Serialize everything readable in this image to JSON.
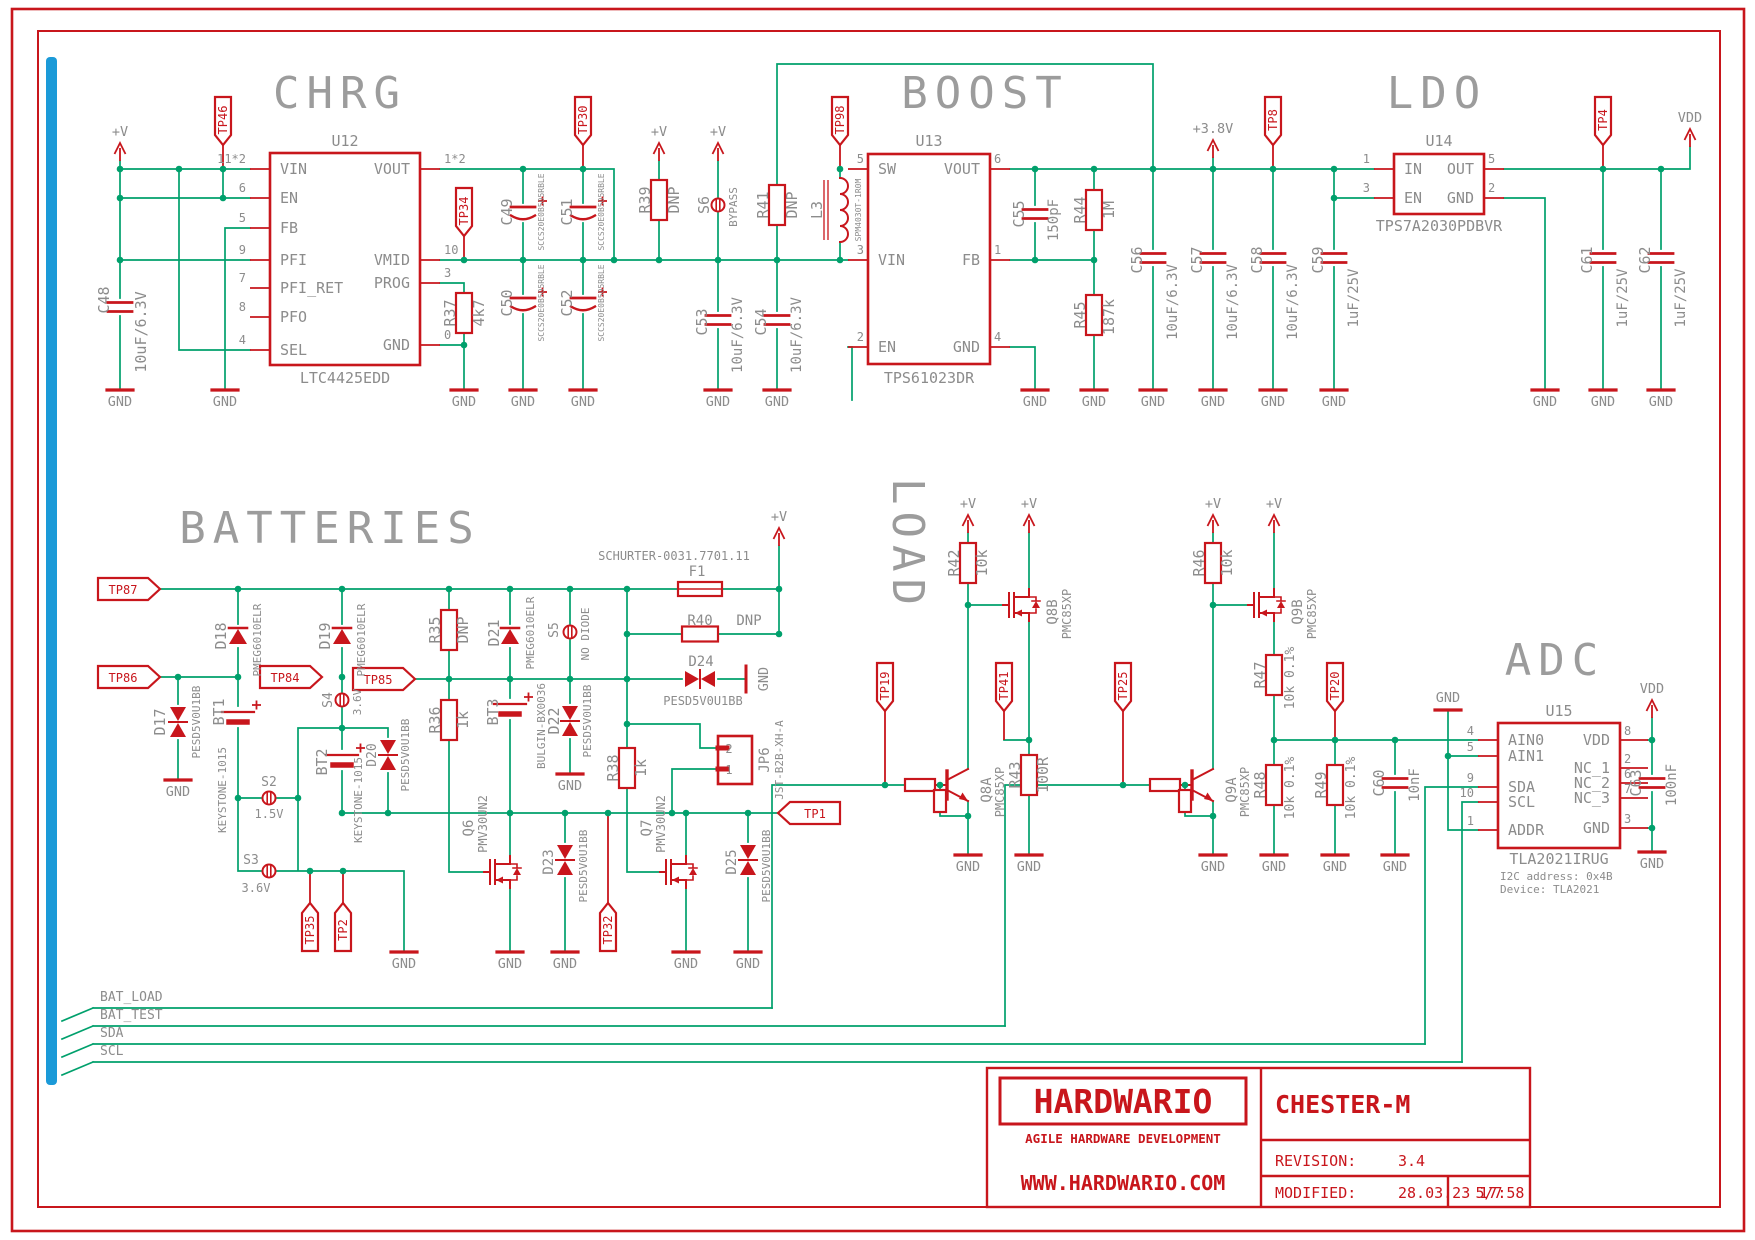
{
  "titles": {
    "chrg": "CHRG",
    "boost": "BOOST",
    "ldo": "LDO",
    "bat": "BATTERIES",
    "load": "LOAD",
    "adc": "ADC"
  },
  "sym": {
    "gnd": "GND",
    "pv": "+V",
    "v38": "+3.8V",
    "vdd": "VDD"
  },
  "tp": {
    "tp1": "TP1",
    "tp2": "TP2",
    "tp4": "TP4",
    "tp8": "TP8",
    "tp19": "TP19",
    "tp20": "TP20",
    "tp25": "TP25",
    "tp30": "TP30",
    "tp32": "TP32",
    "tp34": "TP34",
    "tp35": "TP35",
    "tp41": "TP41",
    "tp46": "TP46",
    "tp84": "TP84",
    "tp85": "TP85",
    "tp86": "TP86",
    "tp87": "TP87",
    "tp98": "TP98"
  },
  "nets": {
    "bat_load": "BAT_LOAD",
    "bat_test": "BAT_TEST",
    "sda": "SDA",
    "scl": "SCL"
  },
  "ics": {
    "u12": {
      "ref": "U12",
      "part": "LTC4425EDD",
      "lp": [
        {
          "num": "11*2",
          "n": "VIN"
        },
        {
          "num": "6",
          "n": "EN"
        },
        {
          "num": "5",
          "n": "FB"
        },
        {
          "num": "9",
          "n": "PFI"
        },
        {
          "num": "7",
          "n": "PFI_RET"
        },
        {
          "num": "8",
          "n": "PFO"
        },
        {
          "num": "4",
          "n": "SEL"
        }
      ],
      "rp": [
        {
          "num": "1*2",
          "n": "VOUT"
        },
        {
          "num": "10",
          "n": "VMID"
        },
        {
          "num": "3",
          "n": "PROG"
        },
        {
          "num": "0",
          "n": "GND"
        }
      ]
    },
    "u13": {
      "ref": "U13",
      "part": "TPS61023DR",
      "lp": [
        {
          "num": "5",
          "n": "SW"
        },
        {
          "num": "3",
          "n": "VIN"
        },
        {
          "num": "2",
          "n": "EN"
        }
      ],
      "rp": [
        {
          "num": "6",
          "n": "VOUT"
        },
        {
          "num": "1",
          "n": "FB"
        },
        {
          "num": "4",
          "n": "GND"
        }
      ]
    },
    "u14": {
      "ref": "U14",
      "part": "TPS7A2030PDBVR",
      "lp": [
        {
          "num": "1",
          "n": "IN"
        },
        {
          "num": "3",
          "n": "EN"
        }
      ],
      "rp": [
        {
          "num": "5",
          "n": "OUT"
        },
        {
          "num": "2",
          "n": "GND"
        }
      ]
    },
    "u15": {
      "ref": "U15",
      "part": "TLA2021IRUG",
      "note1": "I2C address: 0x4B",
      "note2": "Device: TLA2021",
      "lp": [
        {
          "num": "4",
          "n": "AIN0"
        },
        {
          "num": "5",
          "n": "AIN1"
        },
        {
          "num": "9",
          "n": "SDA"
        },
        {
          "num": "10",
          "n": "SCL"
        },
        {
          "num": "1",
          "n": "ADDR"
        }
      ],
      "rp": [
        {
          "num": "8",
          "n": "VDD"
        },
        {
          "num": "2",
          "n": "NC_1"
        },
        {
          "num": "6",
          "n": "NC_2"
        },
        {
          "num": "7",
          "n": "NC_3"
        },
        {
          "num": "3",
          "n": "GND"
        }
      ]
    }
  },
  "parts": {
    "c48": {
      "r": "C48",
      "v": "10uF/6.3V"
    },
    "c49": {
      "r": "C49",
      "v": "SCCS20E0B505RBLE"
    },
    "c50": {
      "r": "C50",
      "v": "SCCS20E0B505RBLE"
    },
    "c51": {
      "r": "C51",
      "v": "SCCS20E0B505RBLE"
    },
    "c52": {
      "r": "C52",
      "v": "SCCS20E0B505RBLE"
    },
    "r37": {
      "r": "R37",
      "v": "4k7"
    },
    "r39": {
      "r": "R39",
      "v": "DNP"
    },
    "s6": {
      "r": "S6",
      "v": "BYPASS"
    },
    "r41": {
      "r": "R41",
      "v": "DNP"
    },
    "l3": {
      "r": "L3",
      "v": "SPM4030T-1R0M"
    },
    "c53": {
      "r": "C53",
      "v": "10uF/6.3V"
    },
    "c54": {
      "r": "C54",
      "v": "10uF/6.3V"
    },
    "c55": {
      "r": "C55",
      "v": "150pF"
    },
    "r44": {
      "r": "R44",
      "v": "1M"
    },
    "r45": {
      "r": "R45",
      "v": "187k"
    },
    "c56": {
      "r": "C56",
      "v": "10uF/6.3V"
    },
    "c57": {
      "r": "C57",
      "v": "10uF/6.3V"
    },
    "c58": {
      "r": "C58",
      "v": "10uF/6.3V"
    },
    "c59": {
      "r": "C59",
      "v": "1uF/25V"
    },
    "c61": {
      "r": "C61",
      "v": "1uF/25V"
    },
    "c62": {
      "r": "C62",
      "v": "1uF/25V"
    },
    "d17": {
      "r": "D17",
      "v": "PESD5V0U1BB"
    },
    "d18": {
      "r": "D18",
      "v": "PMEG6010ELR"
    },
    "d19": {
      "r": "D19",
      "v": "PMEG6010ELR"
    },
    "bt1": {
      "r": "BT1",
      "v": "KEYSTONE-1015"
    },
    "bt2": {
      "r": "BT2",
      "v": "KEYSTONE-1015"
    },
    "bt3": {
      "r": "BT3",
      "v": "BULGIN-BX0036"
    },
    "s2": {
      "r": "S2",
      "v": "1.5V"
    },
    "s3": {
      "r": "S3",
      "v": "3.6V"
    },
    "s4": {
      "r": "S4",
      "v": "3.6V"
    },
    "s5": {
      "r": "S5",
      "v": "NO DIODE"
    },
    "d20": {
      "r": "D20",
      "v": "PESD5V0U1BB"
    },
    "r35": {
      "r": "R35",
      "v": "DNP"
    },
    "r36": {
      "r": "R36",
      "v": "1k"
    },
    "d21": {
      "r": "D21",
      "v": "PMEG6010ELR"
    },
    "d22": {
      "r": "D22",
      "v": "PESD5V0U1BB"
    },
    "q6": {
      "r": "Q6",
      "v": "PMV30UN2"
    },
    "q7": {
      "r": "Q7",
      "v": "PMV30UN2"
    },
    "d23": {
      "r": "D23",
      "v": "PESD5V0U1BB"
    },
    "d24": {
      "r": "D24",
      "v": "PESD5V0U1BB"
    },
    "d25": {
      "r": "D25",
      "v": "PESD5V0U1BB"
    },
    "f1": {
      "r": "F1",
      "v": "SCHURTER-0031.7701.11"
    },
    "r40": {
      "r": "R40",
      "v": "DNP"
    },
    "r38": {
      "r": "R38",
      "v": "1k"
    },
    "jp6": {
      "r": "JP6",
      "v": "JST-B2B-XH-A",
      "p1": "1",
      "p2": "2"
    },
    "r42": {
      "r": "R42",
      "v": "10k"
    },
    "r46": {
      "r": "R46",
      "v": "10k"
    },
    "r43": {
      "r": "R43",
      "v": "100R"
    },
    "q8a": {
      "r": "Q8A",
      "v": "PMC85XP"
    },
    "q8b": {
      "r": "Q8B",
      "v": "PMC85XP"
    },
    "q9a": {
      "r": "Q9A",
      "v": "PMC85XP"
    },
    "q9b": {
      "r": "Q9B",
      "v": "PMC85XP"
    },
    "r47": {
      "r": "R47",
      "v": "10k 0.1%"
    },
    "r48": {
      "r": "R48",
      "v": "10k 0.1%"
    },
    "r49": {
      "r": "R49",
      "v": "10k 0.1%"
    },
    "c60": {
      "r": "C60",
      "v": "10nF"
    },
    "c63": {
      "r": "C63",
      "v": "100nF"
    }
  },
  "tb": {
    "brand": "HARDWARIO",
    "tagline": "AGILE HARDWARE DEVELOPMENT",
    "site": "WWW.HARDWARIO.COM",
    "project": "CHESTER-M",
    "rev_l": "REVISION:",
    "rev": "3.4",
    "mod_l": "MODIFIED:",
    "mod": "28.03.23 17:58",
    "page": "5/7"
  }
}
